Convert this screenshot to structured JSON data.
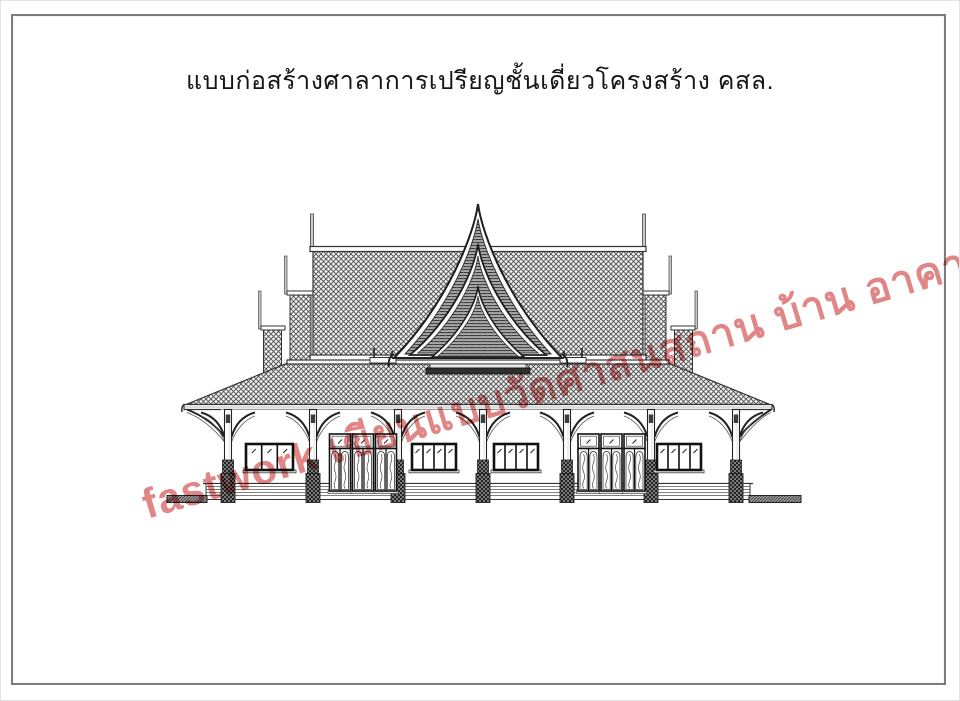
{
  "page": {
    "background_color": "#ffffff",
    "frame_color": "#7d7d7d",
    "title": "แบบก่อสร้างศาลาการเปรียญชั้นเดี่ยวโครงสร้าง คสล."
  },
  "watermark": {
    "text": "fastwork เขียนแบบวัดศาสนสถาน บ้าน อาคาร",
    "color": "#d96464",
    "rotation_deg": -16.5
  },
  "drawing": {
    "type": "architectural-front-elevation",
    "subject": "single-storey Thai sermon hall (sala kan parian)",
    "ink_color": "#222222",
    "hatch_color": "#4d4d4d",
    "columns": 7,
    "roof_tiers_per_side": 3,
    "gable_layers": 3,
    "door_groups": 2,
    "door_leaves_per_group": 3,
    "windows": [
      {
        "position": "bay-1",
        "panes": 3
      },
      {
        "position": "bay-3",
        "panes": 4
      },
      {
        "position": "bay-4",
        "panes": 4
      },
      {
        "position": "bay-6",
        "panes": 4
      }
    ]
  }
}
